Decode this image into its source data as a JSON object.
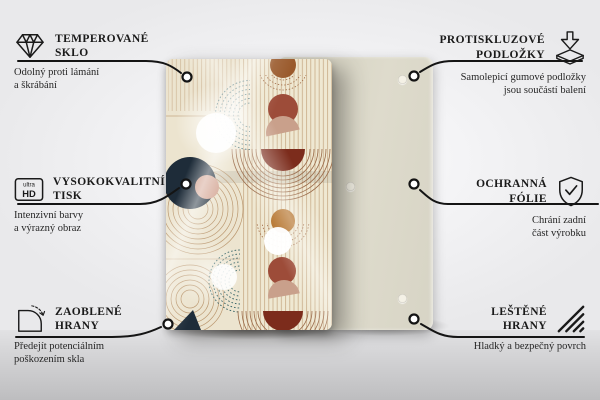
{
  "labels": {
    "left": [
      {
        "icon": "diamond",
        "title_lines": [
          "TEMPEROVANÉ",
          "SKLO"
        ],
        "subtitle_lines": [
          "Odolný proti lámání",
          "a škrábání"
        ]
      },
      {
        "icon": "ultra-hd",
        "icon_text_top": "ultra",
        "icon_text_bottom": "HD",
        "title_lines": [
          "VYSOKOKVALITNÍ",
          "TISK"
        ],
        "subtitle_lines": [
          "Intenzivní barvy",
          "a výrazný obraz"
        ]
      },
      {
        "icon": "rounded-corner",
        "title_lines": [
          "ZAOBLENÉ",
          "HRANY"
        ],
        "subtitle_lines": [
          "Předejít potenciálním",
          "poškozením skla"
        ]
      }
    ],
    "right": [
      {
        "icon": "anti-slip-pads",
        "title_lines": [
          "PROTISKLUZOVÉ",
          "PODLOŽKY"
        ],
        "subtitle_lines": [
          "Samolepicí gumové podložky",
          "jsou součástí balení"
        ]
      },
      {
        "icon": "shield-check",
        "title_lines": [
          "OCHRANNÁ",
          "FÓLIE"
        ],
        "subtitle_lines": [
          "Chrání zadní",
          "část výrobku"
        ]
      },
      {
        "icon": "polished-edges",
        "title_lines": [
          "LEŠTĚNÉ",
          "HRANY"
        ],
        "subtitle_lines": [
          "Hladký a bezpečný povrch"
        ]
      }
    ]
  },
  "colors": {
    "connector_line": "#141414",
    "label_text": "#1a1a1a",
    "back_board": "#dbd8c9",
    "rubber_pad": "#f4f1e6",
    "print": {
      "cream": "#efe8d2",
      "terracotta": "#9d4c39",
      "dark_red": "#7c2c1c",
      "tan": "#c9a08b",
      "pink": "#d3a492",
      "navy": "#1e2c39",
      "teal": "#2f5f63",
      "orange": "#b06a1e",
      "brown": "#9a5a2c",
      "thin_line": "#b28a5e"
    }
  }
}
